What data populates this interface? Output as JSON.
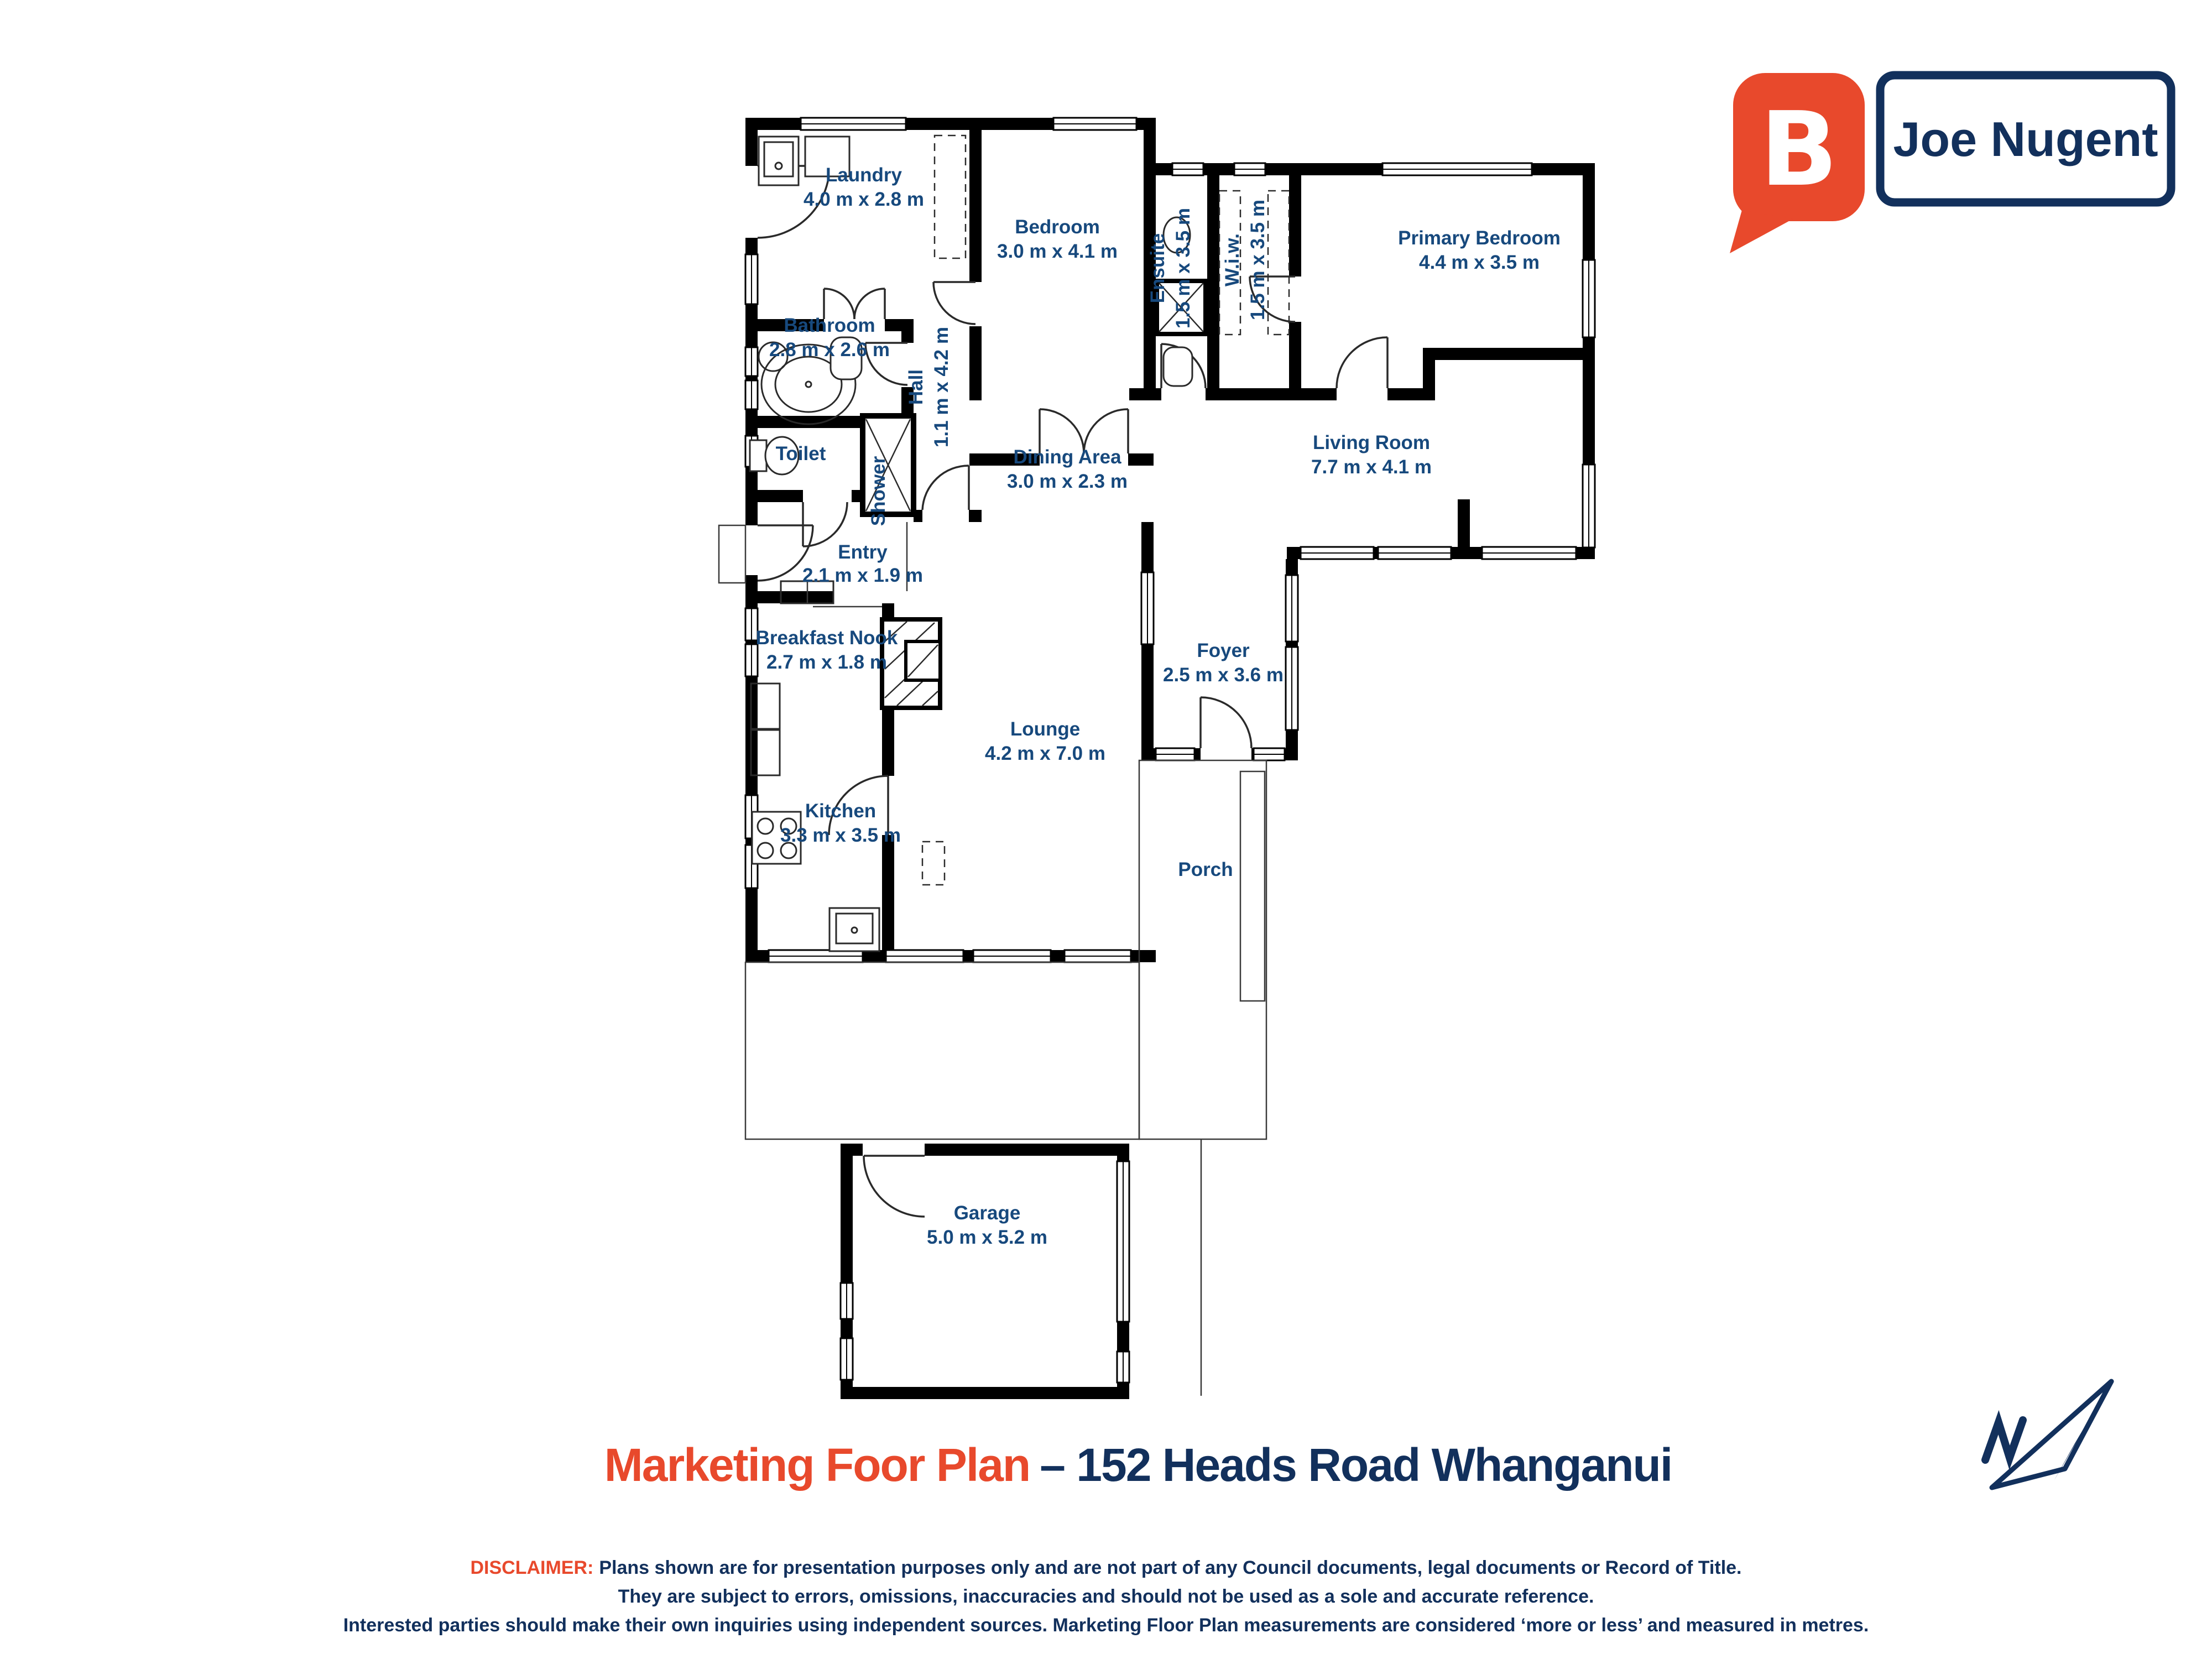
{
  "logo": {
    "brand_letter": "B",
    "agent_name": "Joe Nugent",
    "bubble_color": "#e8492c",
    "navy_color": "#12305c"
  },
  "plan": {
    "label_color": "#17497d",
    "rooms": [
      {
        "name": "Laundry",
        "dims": "4.0 m x 2.8 m"
      },
      {
        "name": "Bedroom",
        "dims": "3.0 m x 4.1 m"
      },
      {
        "name": "Ensuite",
        "dims": "1.5 m x 3.5 m"
      },
      {
        "name": "W.i.w.",
        "dims": "1.5 m x 3.5 m"
      },
      {
        "name": "Primary Bedroom",
        "dims": "4.4 m x 3.5 m"
      },
      {
        "name": "Bathroom",
        "dims": "2.8 m x 2.6 m"
      },
      {
        "name": "Hall",
        "dims": "1.1 m x 4.2 m"
      },
      {
        "name": "Toilet"
      },
      {
        "name": "Shower"
      },
      {
        "name": "Dining Area",
        "dims": "3.0 m x 2.3 m"
      },
      {
        "name": "Living Room",
        "dims": "7.7 m x 4.1 m"
      },
      {
        "name": "Entry",
        "dims": "2.1 m x 1.9 m"
      },
      {
        "name": "Breakfast Nook",
        "dims": "2.7 m x 1.8 m"
      },
      {
        "name": "Foyer",
        "dims": "2.5 m x 3.6 m"
      },
      {
        "name": "Lounge",
        "dims": "4.2 m x 7.0 m"
      },
      {
        "name": "Kitchen",
        "dims": "3.3 m x 3.5 m"
      },
      {
        "name": "Porch"
      },
      {
        "name": "Garage",
        "dims": "5.0 m x 5.2 m"
      }
    ]
  },
  "title": {
    "main": "Marketing Foor Plan",
    "address": "– 152 Heads Road Whanganui",
    "main_color": "#e8492c",
    "address_color": "#12305c"
  },
  "disclaimer": {
    "label": "DISCLAIMER:",
    "line1": "Plans shown are for presentation purposes only and are not part of any Council documents, legal documents or Record of Title.",
    "line2": "They are subject to errors, omissions, inaccuracies and should not be used as a sole and accurate reference.",
    "line3": "Interested parties should make their own inquiries using independent sources. Marketing Floor Plan measurements are considered ‘more or less’ and measured in metres."
  },
  "compass": {
    "label": "N"
  }
}
